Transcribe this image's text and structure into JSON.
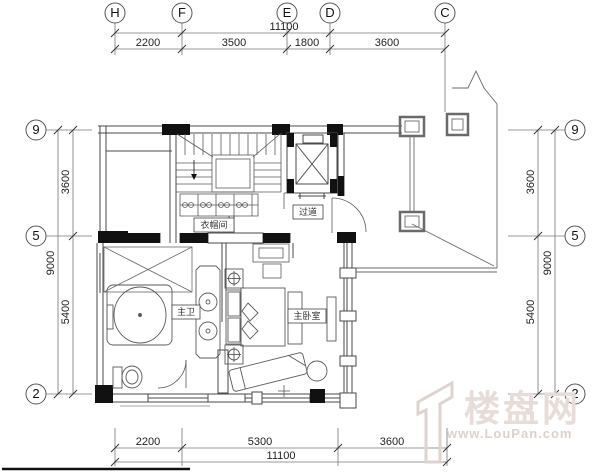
{
  "grid_bubbles": {
    "top": [
      "H",
      "F",
      "E",
      "D",
      "C"
    ],
    "left": [
      "9",
      "5",
      "2"
    ],
    "right": [
      "9",
      "5",
      "2"
    ]
  },
  "dimensions": {
    "top": {
      "total": "11100",
      "seg1": "2200",
      "seg2": "3500",
      "seg3": "1800",
      "seg4": "3600"
    },
    "bottom": {
      "total": "11100",
      "seg1": "2200",
      "seg2": "5300",
      "seg3": "3600"
    },
    "left": {
      "total": "9000",
      "seg1": "3600",
      "seg2": "5400"
    },
    "right": {
      "total": "9000",
      "seg1": "3600",
      "seg2": "5400"
    }
  },
  "rooms": {
    "cloakroom": "衣帽间",
    "corridor": "过道",
    "master_bathroom": "主卫",
    "master_bedroom": "主卧室"
  },
  "watermark": {
    "site_name": "楼盘网",
    "site_url": "www.LouPan.com"
  },
  "colors": {
    "line": "#555555",
    "wall": "#111111",
    "dim_text": "#222222",
    "watermark": "#e2d7d2"
  }
}
